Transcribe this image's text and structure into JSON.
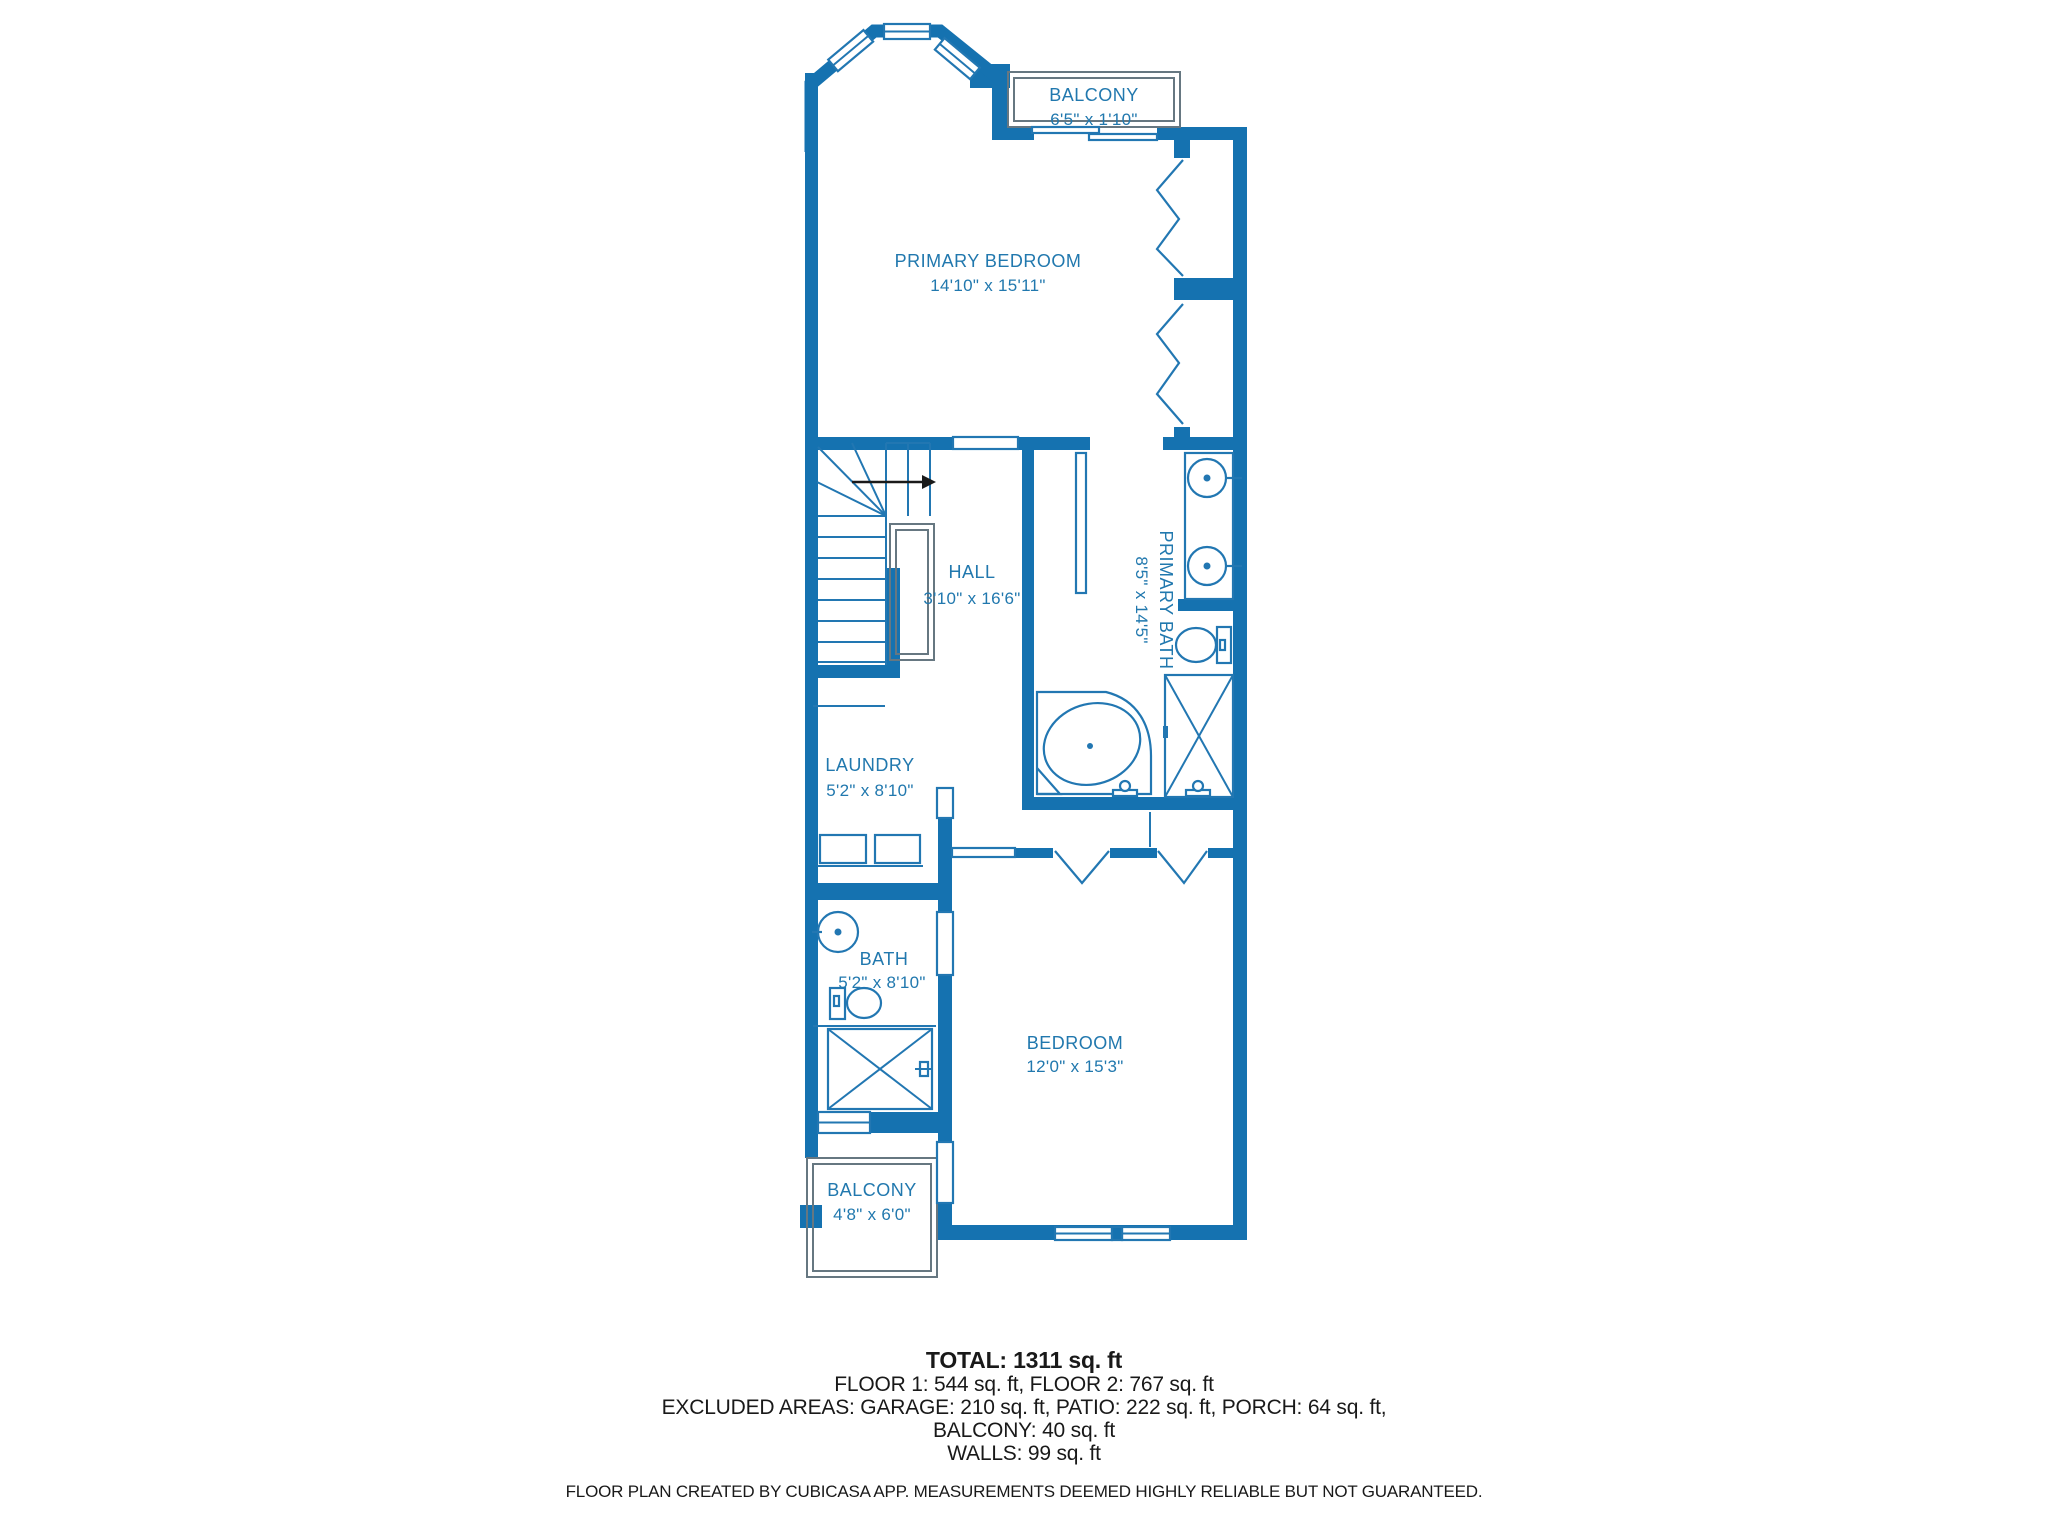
{
  "colors": {
    "wall": "#1572b0",
    "fixture": "#2277b2",
    "label": "#2178ae",
    "railing": "#667781",
    "arrow": "#1a1a1a",
    "text": "#191919",
    "background": "#ffffff"
  },
  "rooms": {
    "balcony_top": {
      "name": "BALCONY",
      "dims": "6'5\" x 1'10\""
    },
    "primary_bedroom": {
      "name": "PRIMARY BEDROOM",
      "dims": "14'10\" x 15'11\""
    },
    "hall": {
      "name": "HALL",
      "dims": "3'10\" x 16'6\""
    },
    "primary_bath": {
      "name": "PRIMARY BATH",
      "dims": "8'5\" x 14'5\""
    },
    "laundry": {
      "name": "LAUNDRY",
      "dims": "5'2\" x 8'10\""
    },
    "bath": {
      "name": "BATH",
      "dims": "5'2\" x 8'10\""
    },
    "bedroom": {
      "name": "BEDROOM",
      "dims": "12'0\" x 15'3\""
    },
    "balcony_bottom": {
      "name": "BALCONY",
      "dims": "4'8\" x 6'0\""
    }
  },
  "summary": {
    "total": "TOTAL: 1311 sq. ft",
    "floors": "FLOOR 1: 544 sq. ft, FLOOR 2: 767 sq. ft",
    "excluded": "EXCLUDED AREAS: GARAGE: 210 sq. ft, PATIO: 222 sq. ft, PORCH: 64 sq. ft,",
    "excluded2": "BALCONY: 40 sq. ft",
    "walls": "WALLS: 99 sq. ft"
  },
  "footer": "FLOOR PLAN CREATED BY CUBICASA APP. MEASUREMENTS DEEMED HIGHLY RELIABLE BUT NOT GUARANTEED."
}
